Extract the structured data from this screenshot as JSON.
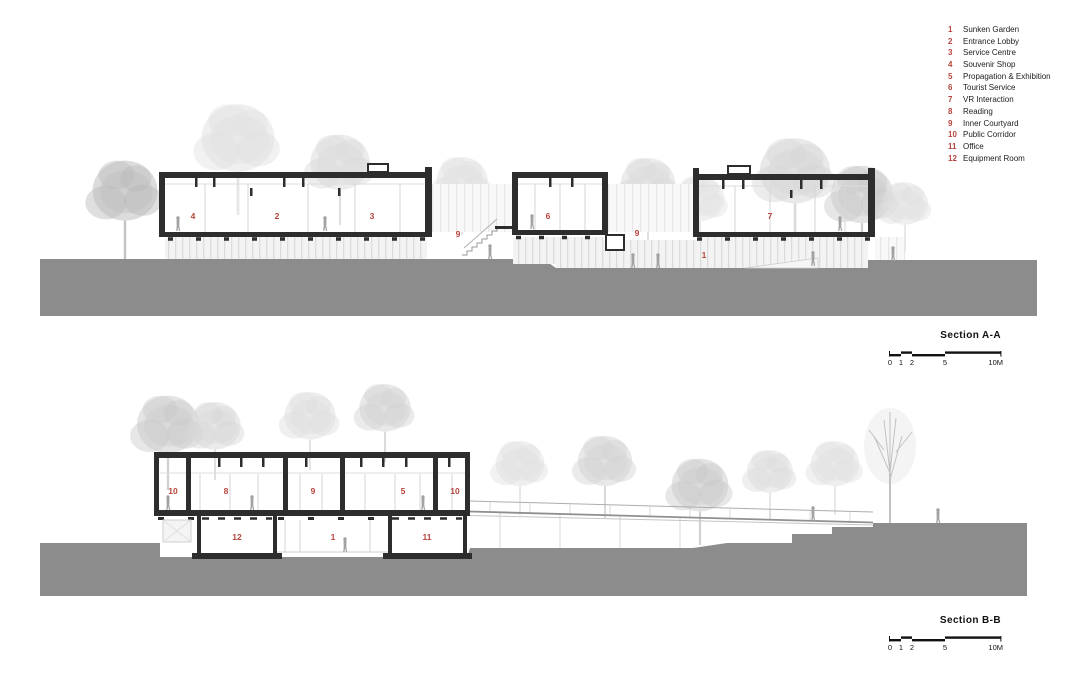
{
  "colors": {
    "accent_red": "#b5453d",
    "ground_gray": "#8c8c8c",
    "line_dark": "#2d2d2d"
  },
  "legend": {
    "items": [
      {
        "num": "1",
        "label": "Sunken Garden"
      },
      {
        "num": "2",
        "label": "Entrance Lobby"
      },
      {
        "num": "3",
        "label": "Service Centre"
      },
      {
        "num": "4",
        "label": "Souvenir Shop"
      },
      {
        "num": "5",
        "label": "Propagation & Exhibition"
      },
      {
        "num": "6",
        "label": "Tourist Service"
      },
      {
        "num": "7",
        "label": "VR Interaction"
      },
      {
        "num": "8",
        "label": "Reading"
      },
      {
        "num": "9",
        "label": "Inner Courtyard"
      },
      {
        "num": "10",
        "label": "Public Corridor"
      },
      {
        "num": "11",
        "label": "Office"
      },
      {
        "num": "12",
        "label": "Equipment Room"
      }
    ]
  },
  "scalebar": {
    "ticks": [
      "0",
      "1",
      "2",
      "5",
      "10M"
    ]
  },
  "sections": {
    "a": {
      "title": "Section A-A",
      "rooms": [
        "4",
        "2",
        "3",
        "9",
        "6",
        "9",
        "1",
        "7"
      ]
    },
    "b": {
      "title": "Section B-B",
      "rooms": [
        "10",
        "8",
        "9",
        "5",
        "10",
        "12",
        "1",
        "11"
      ]
    }
  }
}
